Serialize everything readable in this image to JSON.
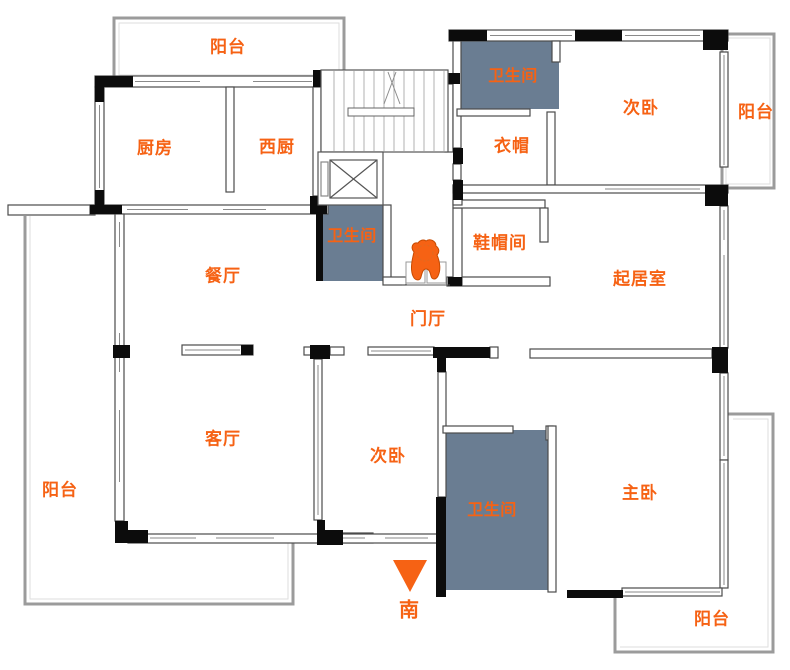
{
  "palette": {
    "accent": "#f66214",
    "bath_fill": "#6a7d92",
    "wall_black": "#0c0c0c",
    "balcony_gray": "#9b9b9b"
  },
  "rooms": {
    "balcony_top": {
      "label": "阳台"
    },
    "kitchen": {
      "label": "厨房"
    },
    "west_kitchen": {
      "label": "西厨"
    },
    "bath_mid": {
      "label": "卫生间"
    },
    "bath_top": {
      "label": "卫生间"
    },
    "cloak": {
      "label": "衣帽"
    },
    "bedroom_top": {
      "label": "次卧"
    },
    "balcony_right": {
      "label": "阳台"
    },
    "shoe_room": {
      "label": "鞋帽间"
    },
    "dining": {
      "label": "餐厅"
    },
    "living": {
      "label": "起居室"
    },
    "hall": {
      "label": "门厅"
    },
    "parlor": {
      "label": "客厅"
    },
    "bedroom_bottom": {
      "label": "次卧"
    },
    "bath_master": {
      "label": "卫生间"
    },
    "master": {
      "label": "主卧"
    },
    "balcony_left": {
      "label": "阳台"
    },
    "balcony_bottom": {
      "label": "阳台"
    }
  },
  "compass": {
    "label": "南"
  }
}
